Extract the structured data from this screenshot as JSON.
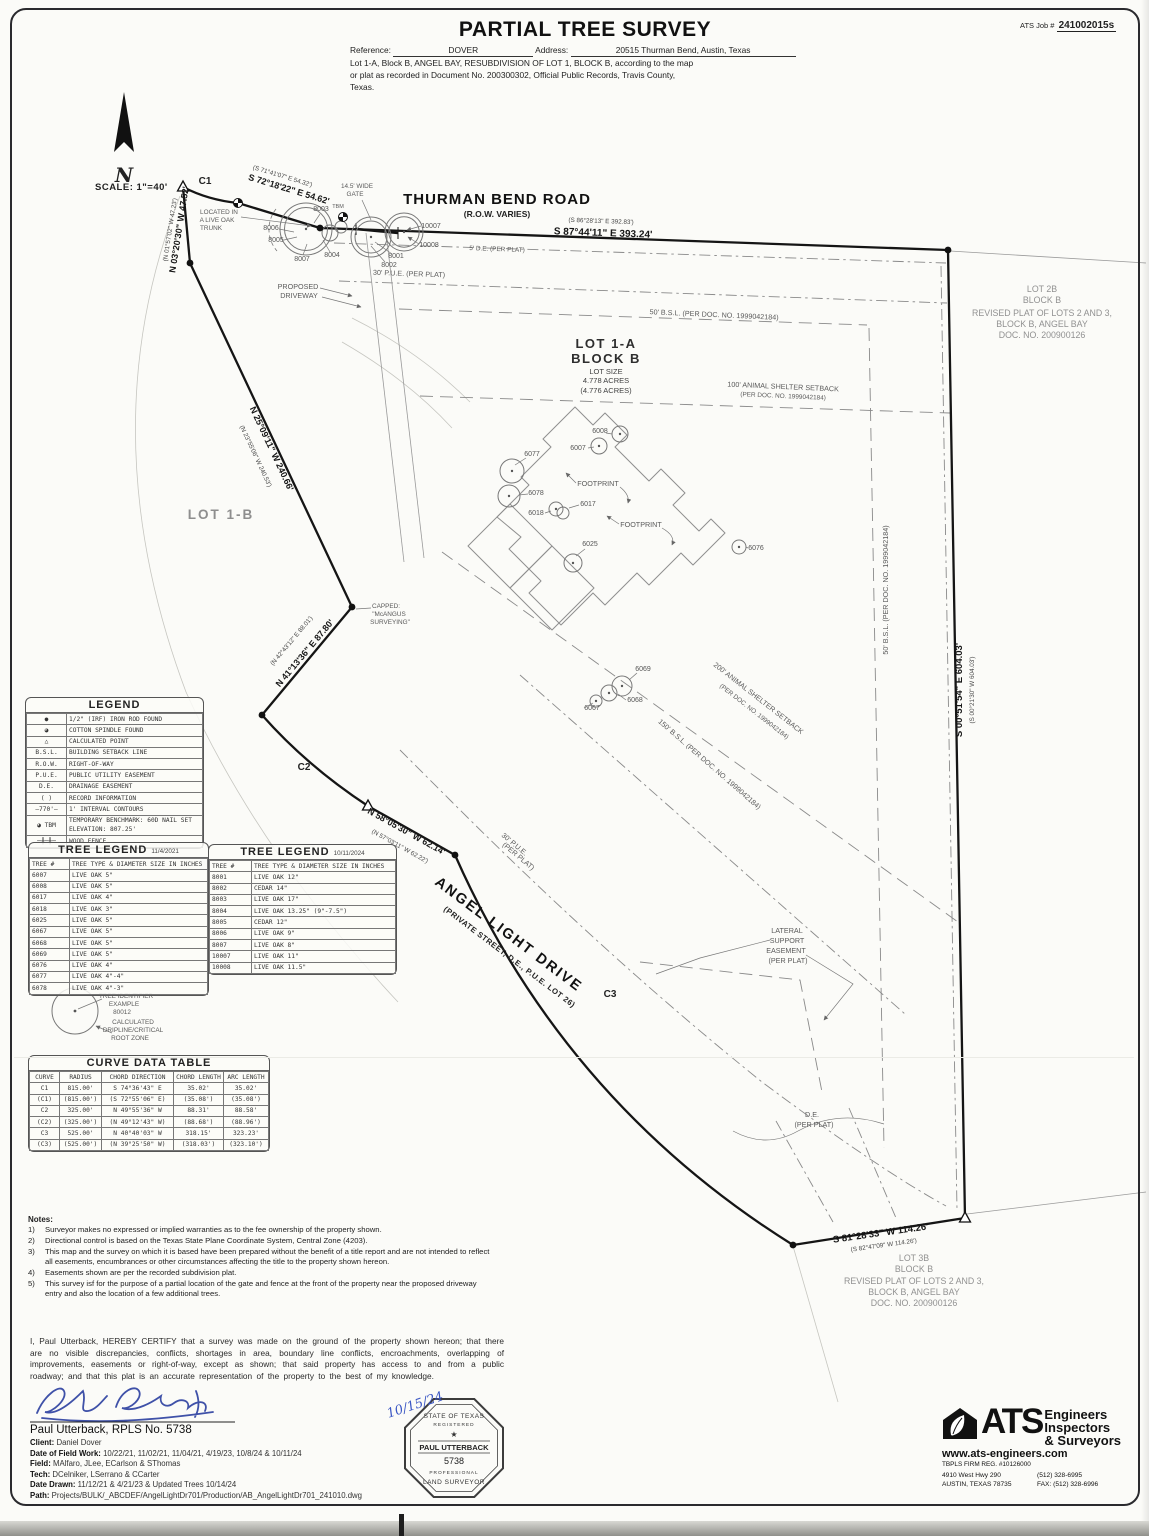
{
  "header": {
    "title": "PARTIAL TREE SURVEY",
    "job_label": "ATS Job #",
    "job_number": "241002015s",
    "reference_label": "Reference:",
    "reference_value": "DOVER",
    "address_label": "Address:",
    "address_value": "20515 Thurman Bend, Austin, Texas",
    "legal1": "Lot 1-A, Block B, ANGEL BAY, RESUBDIVISION OF LOT 1, BLOCK B, according to the map",
    "legal2": "or plat as recorded in Document No. 200300302, Official Public Records, Travis County,",
    "legal3": "Texas."
  },
  "drawing": {
    "scale": "SCALE:  1\"=40'",
    "north": "N",
    "labels": {
      "road1": "THURMAN BEND ROAD",
      "road2": "(R.O.W. VARIES)",
      "brg_top": "S 87°44'11\" E  393.24'",
      "rec_top": "(S 86°28'13\" E  392.83')",
      "brg_gate": "S 72°18'22\" E  54.62'",
      "rec_gate": "(S 71°41'07\" E  54.32')",
      "brg_nw": "N 03°20'30\" W  47.52'",
      "rec_nw": "(N 01°57'02\" W  47.23')",
      "brg_west": "N 25°09'11\" W  240.66'",
      "rec_west": "(N 23°55'06\" W  240.53')",
      "brg_sw": "N 41°13'36\" E  87.80'",
      "rec_sw": "(N 42°43'12\" E  88.01')",
      "brg_ald": "N 58°05'30\" W  62.14'",
      "rec_ald": "(N 57°03'11\" W  62.22')",
      "brg_east": "S 00°51'54\" E  604.03'",
      "rec_east": "(S 00°21'30\" W  604.03')",
      "brg_south": "S 81°28'33\" W  114.26'",
      "rec_south": "(S 82°47'09\" W  114.26')",
      "c1": "C1",
      "c2": "C2",
      "c3": "C3",
      "de5": "5' D.E. (PER PLAT)",
      "pue30": "30' P.U.E. (PER PLAT)",
      "bsl50": "50' B.S.L. (PER DOC. NO. 1999042184)",
      "shelter100a": "100' ANIMAL SHELTER SETBACK",
      "shelter100b": "(PER DOC. NO. 1999042184)",
      "shelter200a": "200' ANIMAL SHELTER SETBACK",
      "shelter200b": "(PER DOC. NO. 1999042184)",
      "bsl150": "150' B.S.L. (PER DOC. NO. 1999042184)",
      "puealda": "30' P.U.E.",
      "puealdb": "(PER PLAT)",
      "angel1": "ANGEL LIGHT DRIVE",
      "angel2": "(PRIVATE STREET, D.E., P.U.E. LOT 26)",
      "lot1a1": "LOT 1-A",
      "lot1a2": "BLOCK B",
      "lot1a3": "LOT SIZE",
      "lot1a4": "4.778 ACRES",
      "lot1a5": "(4.776 ACRES)",
      "lot1b": "LOT 1-B",
      "lot2b1": "LOT 2B",
      "lot2b2": "BLOCK B",
      "lot2b3": "REVISED PLAT OF LOTS 2 AND 3,",
      "lot2b4": "BLOCK B, ANGEL BAY",
      "lot2b5": "DOC. NO. 200900126",
      "lot3b1": "LOT 3B",
      "lot3b2": "BLOCK B",
      "lot3b3": "REVISED PLAT OF LOTS 2 AND 3,",
      "lot3b4": "BLOCK B, ANGEL BAY",
      "lot3b5": "DOC. NO. 200900126",
      "lat1": "LATERAL",
      "lat2": "SUPPORT",
      "lat3": "EASEMENT",
      "lat4": "(PER PLAT)",
      "de1": "D.E.",
      "de2": "(PER PLAT)",
      "gate1": "14.5' WIDE",
      "gate2": "GATE",
      "tbm": "TBM",
      "loc1": "LOCATED IN",
      "loc2": "A LIVE OAK",
      "loc3": "TRUNK",
      "drv1": "PROPOSED",
      "drv2": "DRIVEWAY",
      "cap1": "CAPPED:",
      "cap2": "\"McANGUS",
      "cap3": "SURVEYING\"",
      "fp": "FOOTPRINT",
      "t6007": "6007",
      "t6008": "6008",
      "t6017": "6017",
      "t6018": "6018",
      "t6025": "6025",
      "t6067": "6067",
      "t6068": "6068",
      "t6069": "6069",
      "t6076": "6076",
      "t6077": "6077",
      "t6078": "6078",
      "t8001": "8001",
      "t8002": "8002",
      "t8003": "8003",
      "t8004": "8004",
      "t8005": "8005",
      "t8006": "8006",
      "t8007": "8007",
      "t10007": "10007",
      "t10008": "10008"
    }
  },
  "legend": {
    "title": "LEGEND",
    "rows": [
      [
        "●",
        "1/2\" (IRF) IRON ROD FOUND"
      ],
      [
        "◕",
        "COTTON SPINDLE FOUND"
      ],
      [
        "△",
        "CALCULATED POINT"
      ],
      [
        "B.S.L.",
        "BUILDING SETBACK LINE"
      ],
      [
        "R.O.W.",
        "RIGHT-OF-WAY"
      ],
      [
        "P.U.E.",
        "PUBLIC UTILITY EASEMENT"
      ],
      [
        "D.E.",
        "DRAINAGE EASEMENT"
      ],
      [
        "(    )",
        "RECORD INFORMATION"
      ],
      [
        "—770'—",
        "1' INTERVAL CONTOURS"
      ],
      [
        "◕ TBM",
        "TEMPORARY BENCHMARK: 60D NAIL SET  ELEVATION: 807.25'"
      ],
      [
        "─╫─╫─",
        "WOOD FENCE"
      ]
    ]
  },
  "tree_legend_2021": {
    "title": "TREE LEGEND",
    "date": "11/4/2021",
    "headers": [
      [
        "TREE #",
        "TREE TYPE & DIAMETER SIZE IN INCHES"
      ]
    ],
    "rows": [
      [
        "6007",
        "LIVE OAK 5\""
      ],
      [
        "6008",
        "LIVE OAK 5\""
      ],
      [
        "6017",
        "LIVE OAK 4\""
      ],
      [
        "6018",
        "LIVE OAK 3\""
      ],
      [
        "6025",
        "LIVE OAK 5\""
      ],
      [
        "6067",
        "LIVE OAK 5\""
      ],
      [
        "6068",
        "LIVE OAK 5\""
      ],
      [
        "6069",
        "LIVE OAK 5\""
      ],
      [
        "6076",
        "LIVE OAK 4\""
      ],
      [
        "6077",
        "LIVE OAK 4\"-4\""
      ],
      [
        "6078",
        "LIVE OAK 4\"-3\""
      ]
    ]
  },
  "tree_legend_2024": {
    "title": "TREE LEGEND",
    "date": "10/11/2024",
    "headers": [
      [
        "TREE #",
        "TREE TYPE & DIAMETER SIZE IN INCHES"
      ]
    ],
    "rows": [
      [
        "8001",
        "LIVE OAK 12\""
      ],
      [
        "8002",
        "CEDAR 14\""
      ],
      [
        "8003",
        "LIVE OAK 17\""
      ],
      [
        "8004",
        "LIVE OAK 13.25\" (9\"-7.5\")"
      ],
      [
        "8005",
        "CEDAR 12\""
      ],
      [
        "8006",
        "LIVE OAK 9\""
      ],
      [
        "8007",
        "LIVE OAK 8\""
      ],
      [
        "10007",
        "LIVE OAK 11\""
      ],
      [
        "10008",
        "LIVE OAK 11.5\""
      ]
    ]
  },
  "tree_id_example": {
    "l1": "TREE IDENTIFIER",
    "l2": "EXAMPLE",
    "l3": "80012",
    "c1": "CALCULATED",
    "c2": "DRIPLINE/CRITICAL",
    "c3": "ROOT ZONE"
  },
  "curve_table": {
    "title": "CURVE DATA TABLE",
    "headers": [
      [
        "CURVE",
        "RADIUS",
        "CHORD DIRECTION",
        "CHORD LENGTH",
        "ARC LENGTH"
      ]
    ],
    "rows": [
      [
        "C1",
        "815.00'",
        "S 74°36'43\" E",
        "35.02'",
        "35.02'"
      ],
      [
        "(C1)",
        "(815.00')",
        "(S 72°55'06\" E)",
        "(35.08')",
        "(35.08')"
      ],
      [
        "C2",
        "325.00'",
        "N 49°55'36\" W",
        "88.31'",
        "88.58'"
      ],
      [
        "(C2)",
        "(325.00')",
        "(N 49°12'43\" W)",
        "(88.68')",
        "(88.96')"
      ],
      [
        "C3",
        "525.00'",
        "N 40°40'03\" W",
        "318.15'",
        "323.23'"
      ],
      [
        "(C3)",
        "(525.00')",
        "(N 39°25'50\" W)",
        "(318.03')",
        "(323.10')"
      ]
    ]
  },
  "notes": {
    "title": "Notes:",
    "items": [
      [
        "1)",
        "Surveyor makes no expressed or implied warranties as to the fee ownership of the property shown."
      ],
      [
        "2)",
        "Directional control is based on the Texas State Plane Coordinate System, Central Zone (4203)."
      ],
      [
        "3)",
        "This map and the survey on which it is based have been prepared without the benefit of a title report and are not intended to reflect all easements, encumbrances or other circumstances affecting the title to the property shown hereon."
      ],
      [
        "4)",
        "Easements shown are per the recorded subdivision plat."
      ],
      [
        "5)",
        "This survey isf for the purpose of a partial location of the gate and fence at the front of the property near the proposed driveway entry and also the location of a few additional trees."
      ]
    ]
  },
  "certification": {
    "text": "I, Paul Utterback, HEREBY CERTIFY that a survey was made on the ground of the property shown hereon; that there are no visible discrepancies, conflicts, shortages in area, boundary line conflicts, encroachments, overlapping of improvements, easements or right-of-way, except as shown; that said property has access to and from a public roadway; and that this plat is an accurate representation of the property to the best of my knowledge."
  },
  "footer": {
    "signer": "Paul Utterback, RPLS No. 5738",
    "client_label": "Client:",
    "client": "Daniel Dover",
    "fieldwork_label": "Date of Field Work:",
    "fieldwork": "10/22/21, 11/02/21, 11/04/21, 4/19/23, 10/8/24 & 10/11/24",
    "field_label": "Field:",
    "field": "MAlfaro, JLee, ECarlson & SThomas",
    "tech_label": "Tech:",
    "tech": "DCelniker, LSerrano & CCarter",
    "drawn_label": "Date Drawn:",
    "drawn": "11/12/21 & 4/21/23 & Updated Trees 10/14/24",
    "path_label": "Path:",
    "path": "Projects/BULK/_ABCDEF/AngelLightDr701/Production/AB_AngelLightDr701_241010.dwg"
  },
  "seal": {
    "top": "STATE OF TEXAS",
    "registered": "REGISTERED",
    "star": "★",
    "name": "PAUL UTTERBACK",
    "number": "5738",
    "professional": "PROFESSIONAL",
    "bottom": "LAND SURVEYOR",
    "date": "10/15/24"
  },
  "ats": {
    "name": "ATS",
    "line1": "Engineers",
    "line2": "Inspectors",
    "line3": "& Surveyors",
    "url": "www.ats-engineers.com",
    "reg": "TBPLS FIRM REG. #10126000",
    "addr1": "4910 West Hwy 290",
    "addr2": "AUSTIN, TEXAS 78735",
    "phone": "(512) 328-6995",
    "fax": "FAX: (512) 328-6996"
  }
}
